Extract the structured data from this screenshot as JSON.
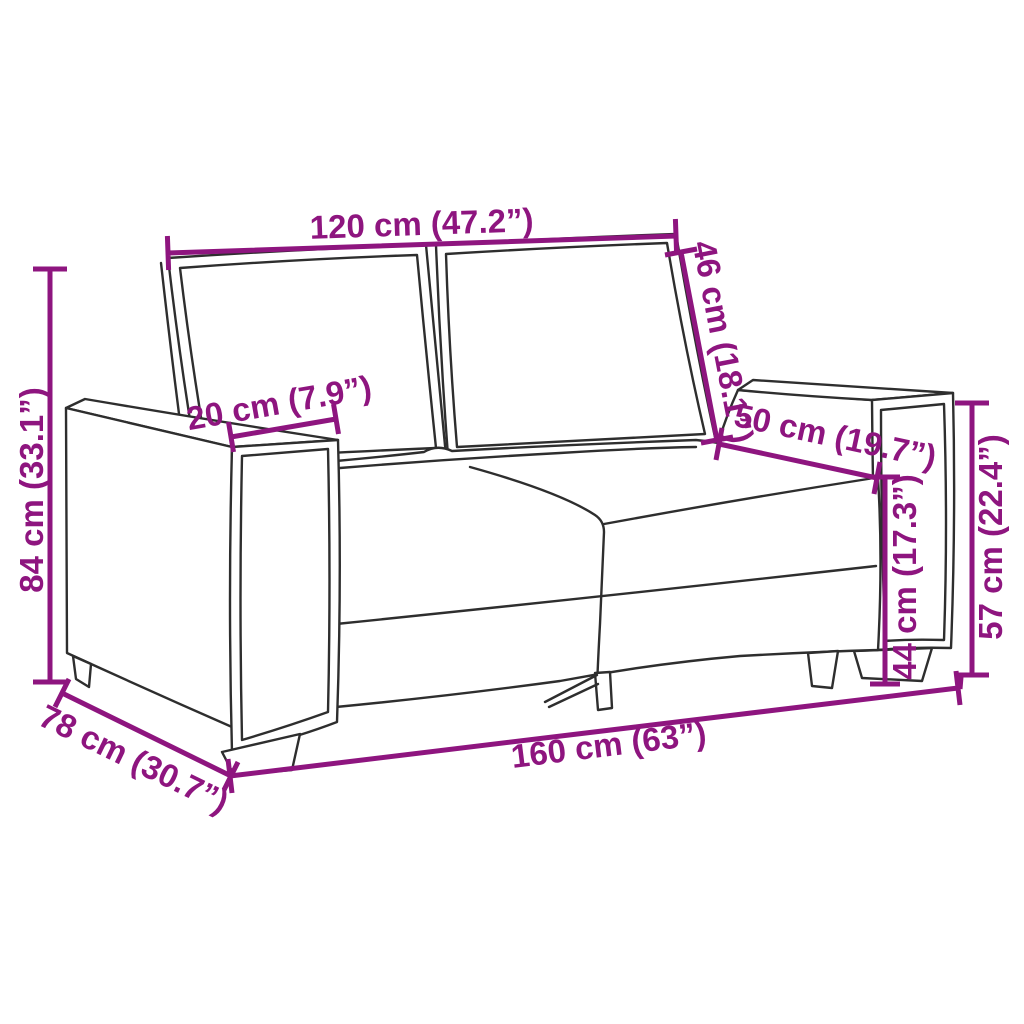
{
  "figure": {
    "type": "product-dimension-diagram",
    "subject": "two-seater sofa line drawing with measurement annotations",
    "background_color": "#ffffff",
    "outline_color": "#2e2e2e",
    "dimension_color": "#8E157F"
  },
  "dimensions": {
    "back_width": {
      "label": "120 cm (47.2”)",
      "cm": 120,
      "inches": 47.2
    },
    "backrest_height": {
      "label": "46 cm (18.1”)",
      "cm": 46,
      "inches": 18.1
    },
    "armrest_width": {
      "label": "20 cm (7.9”)",
      "cm": 20,
      "inches": 7.9
    },
    "seat_depth": {
      "label": "50 cm (19.7”)",
      "cm": 50,
      "inches": 19.7
    },
    "overall_height": {
      "label": "84 cm (33.1”)",
      "cm": 84,
      "inches": 33.1
    },
    "armrest_height": {
      "label": "57 cm (22.4”)",
      "cm": 57,
      "inches": 22.4
    },
    "seat_height": {
      "label": "44 cm (17.3”)",
      "cm": 44,
      "inches": 17.3
    },
    "overall_depth": {
      "label": "78 cm (30.7”)",
      "cm": 78,
      "inches": 30.7
    },
    "overall_width": {
      "label": "160 cm (63”)",
      "cm": 160,
      "inches": 63
    }
  }
}
